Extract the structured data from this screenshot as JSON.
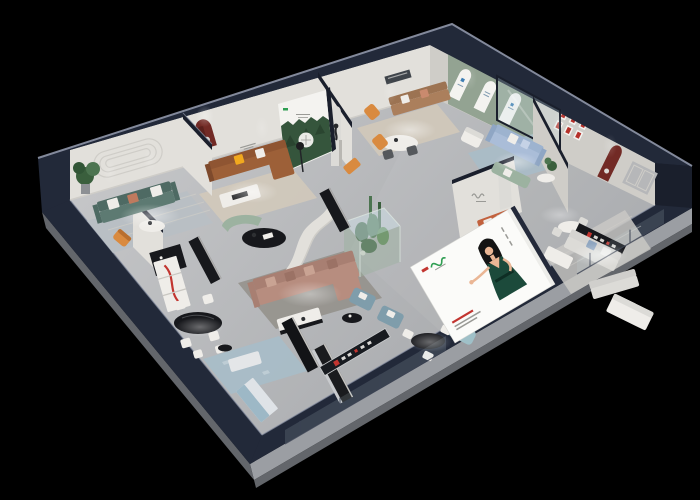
{
  "scene": {
    "type": "3d-isometric-showroom-render",
    "background": "#000000",
    "description": "Isometric cutaway dollhouse view of a furniture showroom with multiple styled living-room vignettes on a black backdrop",
    "shell_color": "#222939"
  },
  "palette": {
    "bg": "#000000",
    "navy": "#222939",
    "navyDeep": "#1a1f2c",
    "navyTop": "#2c3447",
    "edge": "#8f96a8",
    "plinthL": "#9b9ea3",
    "plinthD": "#63666b",
    "floorL": "#c9cacc",
    "floorD": "#a8aaad",
    "wall": "#e2e0db",
    "wallD": "#cfcdc8",
    "greenWall": "#93a392",
    "archW": "#f4f3f0",
    "nicheRed": "#722a25",
    "frameRed": "#b5312a",
    "white": "#efede9",
    "offW": "#dcdbd7",
    "black": "#17181c",
    "rugGray": "#b9bfc4",
    "rugBeige": "#d2c9ba",
    "rugBlue": "#a7bdc9",
    "rugDark": "#8b877f",
    "teal": "#5d7a72",
    "tealD": "#4e6a63",
    "brown": "#9d6038",
    "brownD": "#8f5532",
    "tan": "#ab7f5c",
    "mauve": "#b78d7f",
    "mauveD": "#a87f72",
    "blue": "#aabdd8",
    "blueD": "#9db3cf",
    "sage": "#9cb2a0",
    "terra": "#c2613d",
    "steel": "#7f9dab",
    "paleBlue": "#9fc0c8",
    "orange": "#d98a3f",
    "yellow": "#f1a91e",
    "plant": "#3a5f3d",
    "plantL": "#4c7450",
    "forest": "#35553c",
    "glass": "#cfe2ea",
    "skin": "#eab695",
    "hair": "#141414",
    "dress": "#1c4a3b",
    "logoG": "#2f9e52",
    "logoR": "#c23530",
    "salmon": "#c98a6e",
    "txtGray": "#9a9a96"
  },
  "rooms": [
    {
      "name": "living-room-teal",
      "furniture": [
        "teal-sofa",
        "potted-plant",
        "round-coffee-table",
        "striped-rug",
        "orange-accent-chair",
        "wall-molding"
      ]
    },
    {
      "name": "living-room-leather",
      "furniture": [
        "brown-leather-sofa",
        "yellow-pillow",
        "white-coffee-table",
        "dark-red-arch-niche",
        "floor-lamp",
        "forest-lightbox-poster"
      ]
    },
    {
      "name": "lounge-gallery",
      "furniture": [
        "tan-sofa",
        "white-oval-dining-table",
        "orange-lounge-chairs",
        "statue-pedestal",
        "arch-panel",
        "wall-art-strip"
      ]
    },
    {
      "name": "arch-gallery",
      "furniture": [
        "sage-green-arch-wall",
        "three-white-arch-panels",
        "white-armchair"
      ]
    },
    {
      "name": "living-room-blue",
      "furniture": [
        "periwinkle-sofa",
        "sage-loveseat",
        "round-side-table",
        "glass-partition",
        "red-framed-prints"
      ]
    },
    {
      "name": "showroom-right",
      "furniture": [
        "white-sofa-set",
        "small-dining-table",
        "brand-sign-board",
        "bed-ottoman",
        "dark-red-arch-niche",
        "gray-door-panels"
      ]
    },
    {
      "name": "center-lounge",
      "furniture": [
        "mauve-sectional-sofa",
        "white-coffee-table",
        "black-oval-table",
        "teal-curved-bench",
        "curved-partition-wall",
        "glass-plant-terrarium",
        "cacti",
        "logo-partition-wall",
        "terracotta-sofa"
      ]
    },
    {
      "name": "front-dining",
      "furniture": [
        "black-oval-dining-table",
        "white-chairs",
        "red-accent-display-shelf",
        "black-sideboard",
        "blue-patterned-rug",
        "white-bench",
        "blue-front-cabinet"
      ]
    },
    {
      "name": "front-lounge",
      "furniture": [
        "black-console-tables",
        "round-black-table",
        "white-chairs",
        "steel-blue-armchairs",
        "pale-blue-ottoman",
        "brand-rail-sign",
        "glass-railing"
      ]
    }
  ],
  "billboard": {
    "kind": "illustrated-brand-poster",
    "figure": "woman-in-green-dress",
    "logo_colors": [
      "#c23530",
      "#2f9e52"
    ],
    "background": "#fbfbf9"
  },
  "posters": {
    "forest_lightbox": {
      "image": "pine-forest",
      "emblem": "circular-badge",
      "background": "#f2f1ee"
    }
  }
}
